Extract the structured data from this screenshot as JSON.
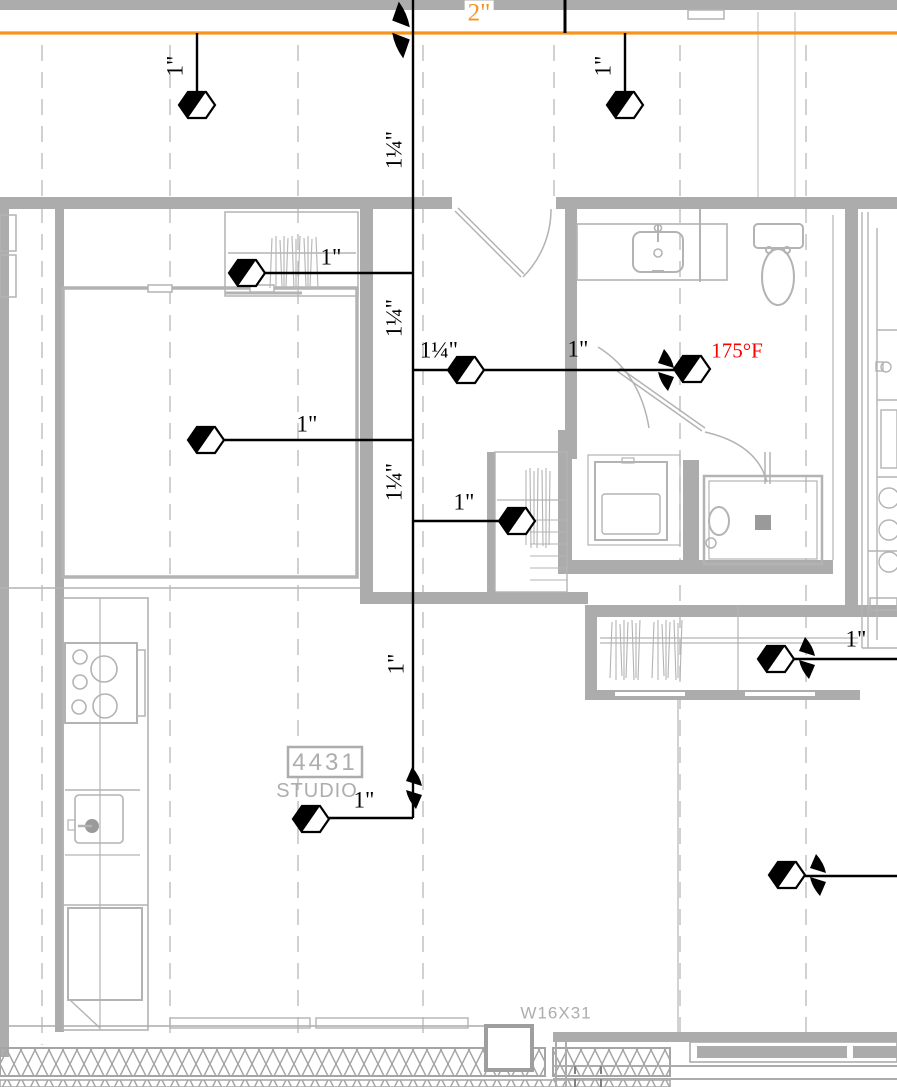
{
  "pipe_labels": {
    "main": "2\"",
    "drop_top_left": "1\"",
    "drop_top_right": "1\"",
    "riser_upper": "1¼\"",
    "riser_mid": "1¼\"",
    "riser_lower": "1¼\"",
    "riser_bottom": "1\"",
    "branch_closet": "1\"",
    "branch_bath_main": "1¼\"",
    "branch_bath_head": "1\"",
    "branch_bedroom": "1\"",
    "branch_linen": "1\"",
    "branch_right_upper": "1\"",
    "branch_studio": "1\""
  },
  "temperature_tag": "175°F",
  "room_tag": {
    "number": "4431",
    "name": "STUDIO"
  },
  "beam_label": "W16X31",
  "colors": {
    "main_pipe": "#F7941D",
    "branch_pipe": "#000000",
    "temperature_text": "#FF0000",
    "plan_lines": "#ADADAD"
  },
  "symbols": {
    "sprinkler_head": "half-filled-hexagon",
    "pipe_break": "double-zigzag",
    "sprinkler_head_count": 10,
    "pipe_break_count": 5
  }
}
